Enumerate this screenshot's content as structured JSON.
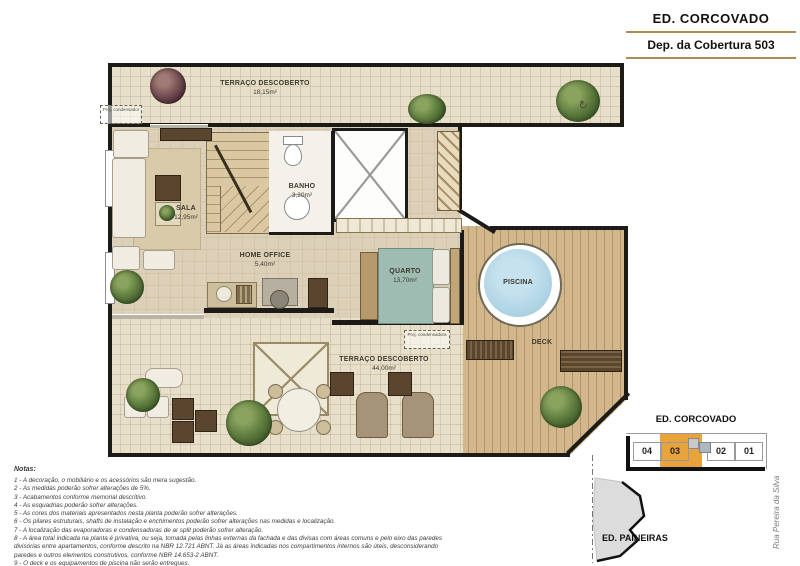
{
  "header": {
    "building": "ED. CORCOVADO",
    "unit": "Dep. da Cobertura 503"
  },
  "plan": {
    "rooms": [
      {
        "name": "TERRAÇO DESCOBERTO",
        "area": "18,15m²"
      },
      {
        "name": "SALA",
        "area": "12,95m²"
      },
      {
        "name": "BANHO",
        "area": "3,20m²"
      },
      {
        "name": "HOME OFFICE",
        "area": "5,40m²"
      },
      {
        "name": "QUARTO",
        "area": "13,70m²"
      },
      {
        "name": "PISCINA",
        "area": ""
      },
      {
        "name": "DECK",
        "area": ""
      },
      {
        "name": "TERRAÇO DESCOBERTO",
        "area": "44,00m²"
      }
    ],
    "annotations": {
      "proj_condensador": "Proj. condensador",
      "proj_condensadora": "Proj. condensadora"
    },
    "icons": {
      "north_arrow_glyph": "↻"
    }
  },
  "notes": {
    "title": "Notas:",
    "items": [
      "1 - A decoração, o mobiliário e os acessórios são mera sugestão.",
      "2 - As medidas poderão sofrer alterações de 5%.",
      "3 - Acabamentos conforme memorial descritivo.",
      "4 - As esquadrias poderão sofrer alterações.",
      "5 - As cores dos materiais apresentados nesta planta poderão sofrer alterações.",
      "6 - Os pilares estruturais, shafts de instalação e enchimentos poderão sofrer alterações nas medidas e localização.",
      "7 - A localização das evaporadoras e condensadoras de ar split poderão sofrer alteração.",
      "8 - A área total indicada na planta é privativa, ou seja, tomada pelas linhas externas da fachada e das divisas com áreas comuns e pelo eixo das paredes divisórias entre apartamentos, conforme descrito na NBR 12.721 ABNT. Já as áreas indicadas nos compartimentos internos são úteis, desconsiderando paredes e outros elementos construtivos, conforme NBR 14.653-2 ABNT.",
      "9 - O deck e os equipamentos de piscina não serão entregues."
    ]
  },
  "keyplan": {
    "title": "ED. CORCOVADO",
    "units": [
      "04",
      "03",
      "02",
      "01"
    ],
    "highlighted_unit": "03",
    "highlight_color": "#E8A33D",
    "neighbor_label": "ED. PAINEIRAS",
    "street_label": "Rua Pereira da Silva"
  },
  "colors": {
    "gold_rule": "#B08A4E",
    "wall": "#1C1B17",
    "terrace_tile": "#E7DFC9",
    "interior_floor": "#DCD1B8",
    "deck_wood": "#D3B78C",
    "pool_water": "#AFD4E4",
    "bed": "#9FBCB2",
    "plant_green": "#5D7B3D",
    "keyplan_highlight": "#E8A33D"
  }
}
